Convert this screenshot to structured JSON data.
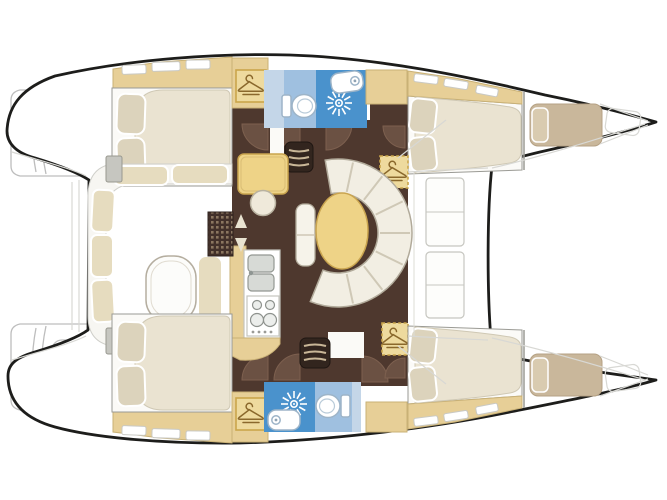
{
  "canvas": {
    "width": 667,
    "height": 500,
    "background": "#ffffff"
  },
  "palette": {
    "bg": "#ffffff",
    "hull_outline": "#1d1d1b",
    "gray_outline": "#bdbdbd",
    "faint_line": "#d8d8d4",
    "wood": "#e7cf97",
    "wood_border": "#c9b176",
    "floor_brown": "#4e382e",
    "floor_light": "#6b5143",
    "soft_white": "#fbfaf7",
    "frame_stroke": "#9a9a94",
    "mattress": "#eae3d1",
    "pillow": "#dcd3bc",
    "cockpit_cushion": "#e6dcbf",
    "sofa": "#f2eee3",
    "sofa_stroke": "#b1aa9a",
    "table_yellow": "#eed387",
    "table_stroke": "#c9a44f",
    "blue_deep": "#4a92cc",
    "blue_mid": "#9fc0e0",
    "blue_pale": "#c4d6e8",
    "fixture_stroke": "#9db4c8",
    "steps_dark": "#32251e",
    "step_line": "#c8b697",
    "hanger_fill": "#eeda9e",
    "hanger_stroke": "#caa54b",
    "hanger_glyph": "#8a682c",
    "counter_stroke": "#c4c4be",
    "sink_gray": "#d7dad6",
    "grate_dot": "#8b7660",
    "block_gray": "#c6c6c0",
    "forepeak_berth": "#c9b79b",
    "forepeak_pillow": "#d9cbb0",
    "arrow": "#e8e2d0"
  },
  "icons": [
    "hanger-icon",
    "shower-head-icon",
    "toilet-icon",
    "washbasin-icon",
    "stairs-icon",
    "door-swing-icon",
    "up-down-arrows-icon",
    "deck-grate-icon"
  ],
  "regions": {
    "cockpit": [
      "bench-seating",
      "cockpit-table",
      "deck-grate",
      "transom-steps-port",
      "transom-steps-starboard"
    ],
    "salon": [
      "chart-table",
      "stool",
      "dinette-sofa",
      "dinette-table",
      "galley-counter",
      "double-sink",
      "stove",
      "companionway-steps-port",
      "companionway-steps-starboard",
      "forward-window-hatches"
    ],
    "port_hull": [
      "aft-cabin-bed",
      "wardrobe",
      "bathroom",
      "toilet",
      "shower",
      "washbasin",
      "forward-cabin-bed",
      "forepeak-berth"
    ],
    "starboard_hull": [
      "aft-cabin-bed",
      "wardrobe",
      "bathroom",
      "toilet",
      "shower",
      "washbasin",
      "forward-cabin-bed",
      "forepeak-berth"
    ]
  }
}
